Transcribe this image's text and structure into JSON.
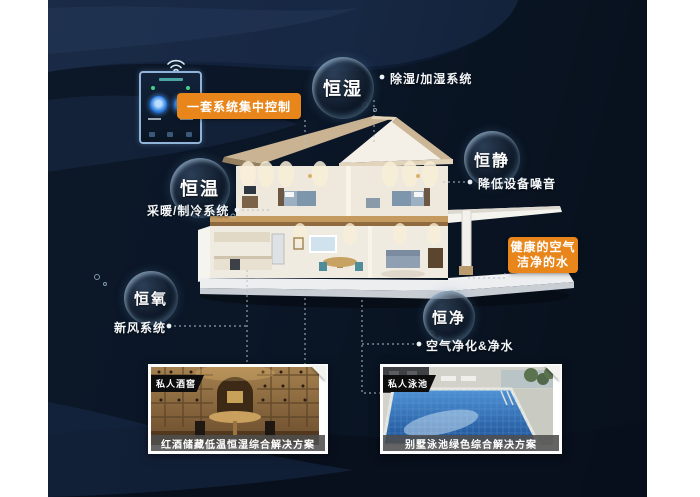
{
  "page": {
    "type": "smart-home-system-infographic"
  },
  "control": {
    "label": "一套系统集中控制",
    "device_name": "wall-smart-controller"
  },
  "features": {
    "humidity": {
      "label": "恒湿",
      "note": "除湿/加湿系统"
    },
    "quiet": {
      "label": "恒静",
      "note": "降低设备噪音"
    },
    "temperature": {
      "label": "恒温",
      "note": "采暖/制冷系统"
    },
    "oxygen": {
      "label": "恒氧",
      "note": "新风系统"
    },
    "clean": {
      "label": "恒净",
      "note": "空气净化&净水"
    }
  },
  "benefit": {
    "line1": "健康的空气",
    "line2": "洁净的水"
  },
  "photos": {
    "wine": {
      "tag": "私人酒窖",
      "caption": "红酒储藏低温恒湿综合解决方案"
    },
    "pool": {
      "tag": "私人泳池",
      "caption": "别墅泳池绿色综合解决方案"
    }
  },
  "colors": {
    "accent": "#E8861C",
    "background": "#0C1A2C",
    "bubble_rim": "#AFCBE0",
    "text": "#FFFFFF"
  },
  "icons": {
    "wifi": "wifi-icon",
    "controller": "smart-panel-icon"
  }
}
